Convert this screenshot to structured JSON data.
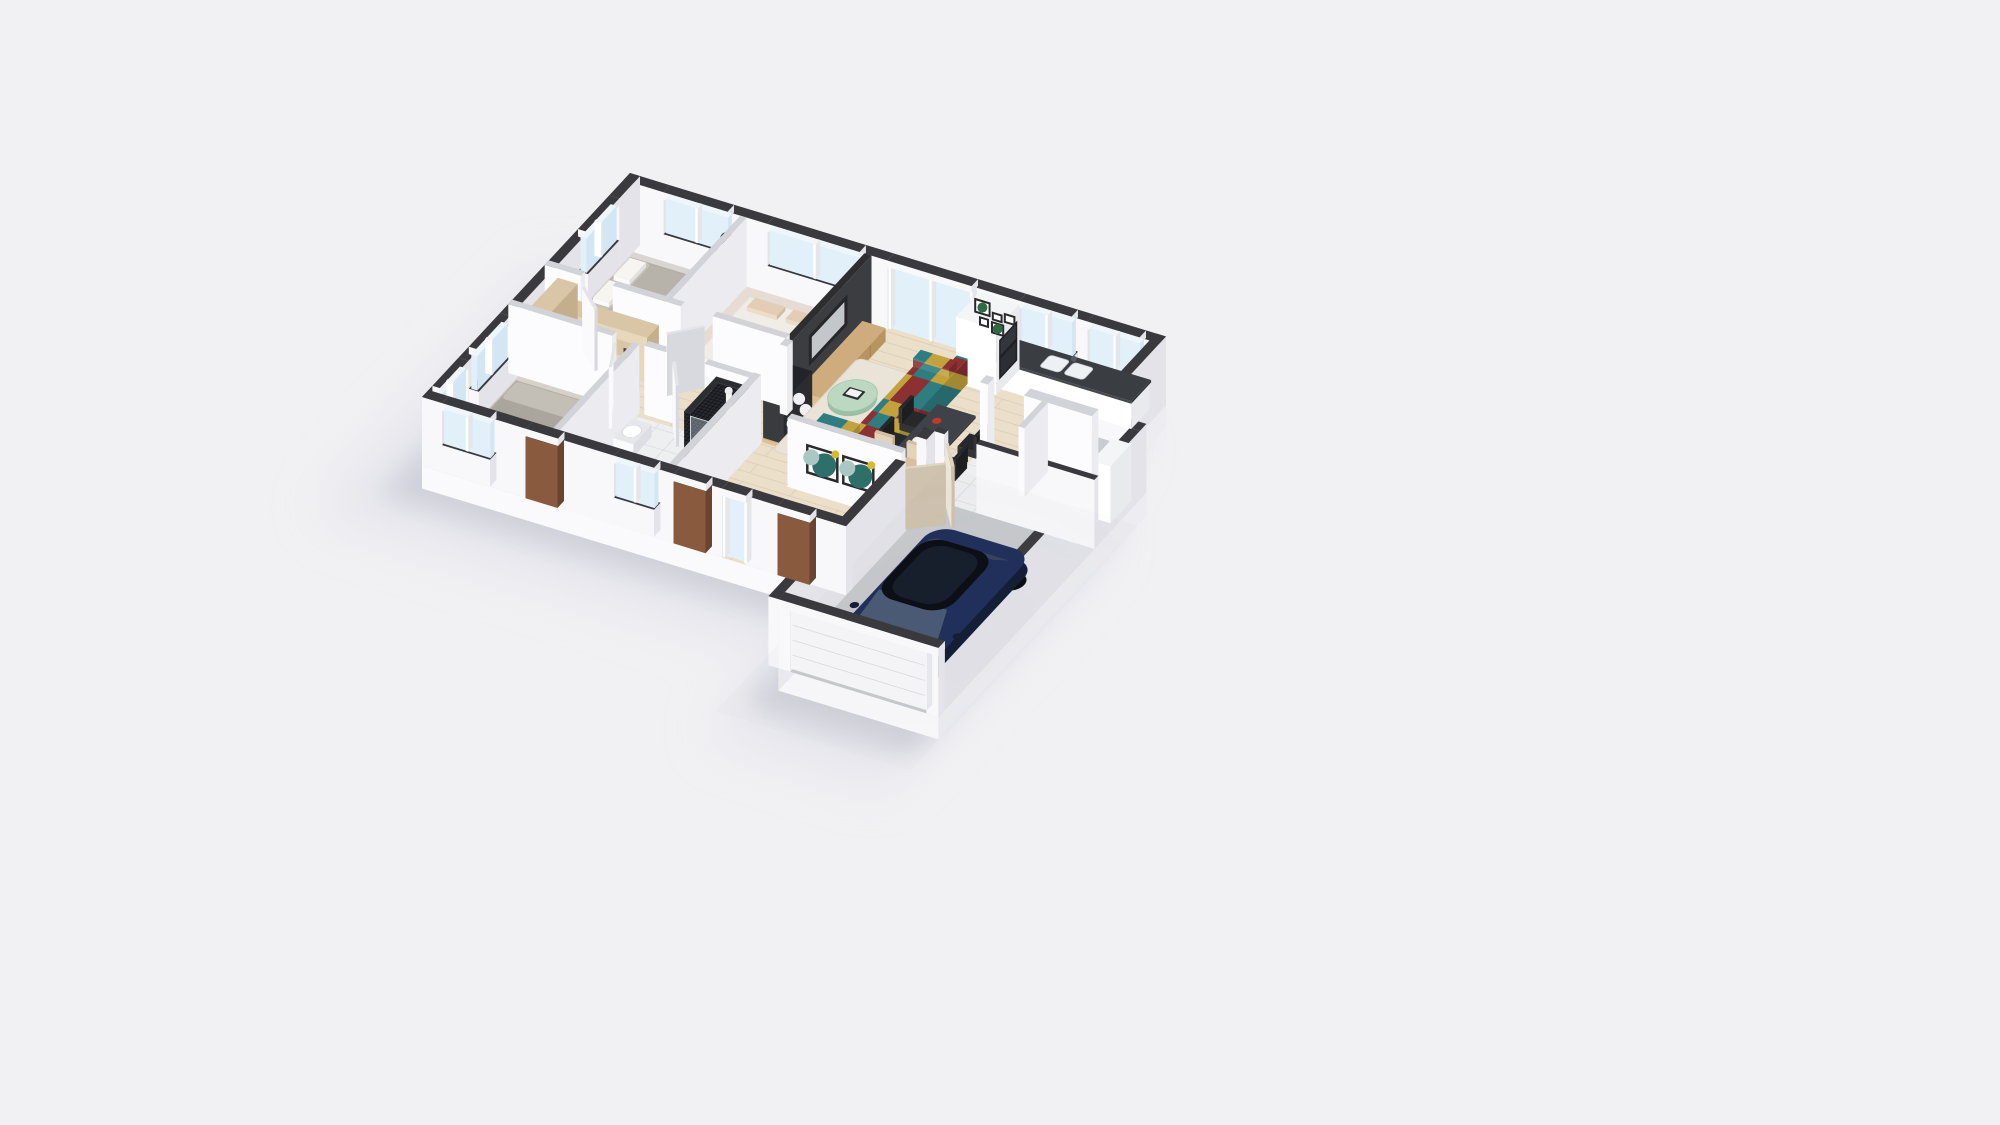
{
  "scene": {
    "kind": "isometric-3d-floorplan-render",
    "background": "#f1f1f4",
    "rooms": [
      {
        "id": "bedroom-1",
        "floor": "carpet_a"
      },
      {
        "id": "bedroom-2",
        "floor": "carpet_b"
      },
      {
        "id": "living-dining",
        "floor": "wood"
      },
      {
        "id": "kitchen",
        "floor": "wood"
      },
      {
        "id": "hallway",
        "floor": "wood"
      },
      {
        "id": "closet",
        "floor": "wood"
      },
      {
        "id": "master-bedroom",
        "floor": "carpet_c"
      },
      {
        "id": "bathroom",
        "floor": "tile"
      },
      {
        "id": "entry",
        "floor": "wood"
      },
      {
        "id": "utility-corridor",
        "floor": "tile"
      },
      {
        "id": "laundry",
        "floor": "tile"
      },
      {
        "id": "garage",
        "floor": "concrete"
      }
    ],
    "furniture": [
      "bed-1",
      "floor-lamp",
      "bed-2",
      "closet-shelving",
      "master-bed",
      "media-wall",
      "tv",
      "tv-sideboard",
      "etagere-shelf",
      "wall-art-cluster",
      "area-rug",
      "patchwork-sofa",
      "coffee-table",
      "dining-table",
      "dining-chairs",
      "kitchen-counter",
      "kitchen-sink",
      "oven-column",
      "washer-dryer",
      "laundry-cabinet",
      "shower",
      "toilet",
      "vanity",
      "console-desk",
      "desk-chairs",
      "entry-art",
      "entry-bench",
      "travel-bag",
      "car",
      "garage-door",
      "front-doors",
      "windows",
      "interior-doors"
    ],
    "palette": {
      "bg": "#f1f1f4",
      "shadow1": "#cdcdd8",
      "shadow2": "#dedee7",
      "slab_top": "#f2f2f5",
      "slab_light": "#fafafc",
      "slab_shade": "#ececf1",
      "ext_top": "#3a3a3e",
      "ext_light": "#f8f8fa",
      "ext_shade": "#e3e3e9",
      "int_top": "#d2d3d8",
      "int_light": "#fcfcfe",
      "int_shade": "#ebebf0",
      "media_top": "#2e2e31",
      "media_light": "#4a4b4f",
      "media_shade": "#3c3d41",
      "wood_base": "#ebdfca",
      "wood_line": "#dbccb1",
      "carpet_a": "#d9d6d2",
      "carpet_b": "#e6dcd4",
      "carpet_c": "#d6d1c9",
      "tile_base": "#edeff1",
      "tile_line": "#d8dbde",
      "mosaic_base": "#101114",
      "mosaic_dot": "#282a2f",
      "concrete": "#c7c9cc",
      "rug": "#e9e3d8",
      "glass_top": "#eef6fc",
      "glass_light": "#e2f0fa",
      "glass_shade": "#d2e6f4",
      "frame_white": "#ffffff",
      "door_brown_top": "#5e3a28",
      "door_brown_light": "#8a5a3e",
      "door_brown_shade": "#6b4430",
      "garage_door": "#f4f4f7",
      "garage_door_line": "#d9dade",
      "counter_top": "#3a3d42",
      "counter_side": "#2f3237",
      "appliance_dark": "#33363b",
      "washer_body": "#d8dadd",
      "washer_door": "#24262b",
      "washer_ring": "#9aa0a7",
      "marble_top": "#3f4248",
      "marble_light": "#50535a",
      "marble_shade": "#33363c",
      "chair_black": "#26282b",
      "chair_beige": "#d6bfa4",
      "desk_wood": "#dcc9ab",
      "bench_wood": "#cbb091",
      "closet_wood": "#d9c6a6",
      "sofa_colors": [
        "#2e7d80",
        "#c03a2b",
        "#31496b",
        "#c2a23d",
        "#c8682b",
        "#86a9b8",
        "#8c3032",
        "#5c7d44",
        "#3f5d8c"
      ],
      "coffee_top": "#bcd8c0",
      "coffee_side": "#9cbfa3",
      "car_base": "#141e36",
      "car_body": "#20305a",
      "car_hood": "#2c4070",
      "car_roof": "#0c1016",
      "car_glass": "#4a5a74",
      "car_sheen": "#1a2230",
      "bed_gray": "#b2ada5",
      "bed_light": "#eeeae4",
      "pillow_white": "#f6f5f2",
      "pillow_beige": "#e3cdb6",
      "art_teal": "#2f6f6a",
      "art_soft": "#a9c8c4",
      "art_yellow": "#d9b832",
      "plant_green": "#2f6b45",
      "bag_red": "#b3302e",
      "bag_dark": "#232225",
      "lamp_black": "#1a1a1d"
    }
  }
}
